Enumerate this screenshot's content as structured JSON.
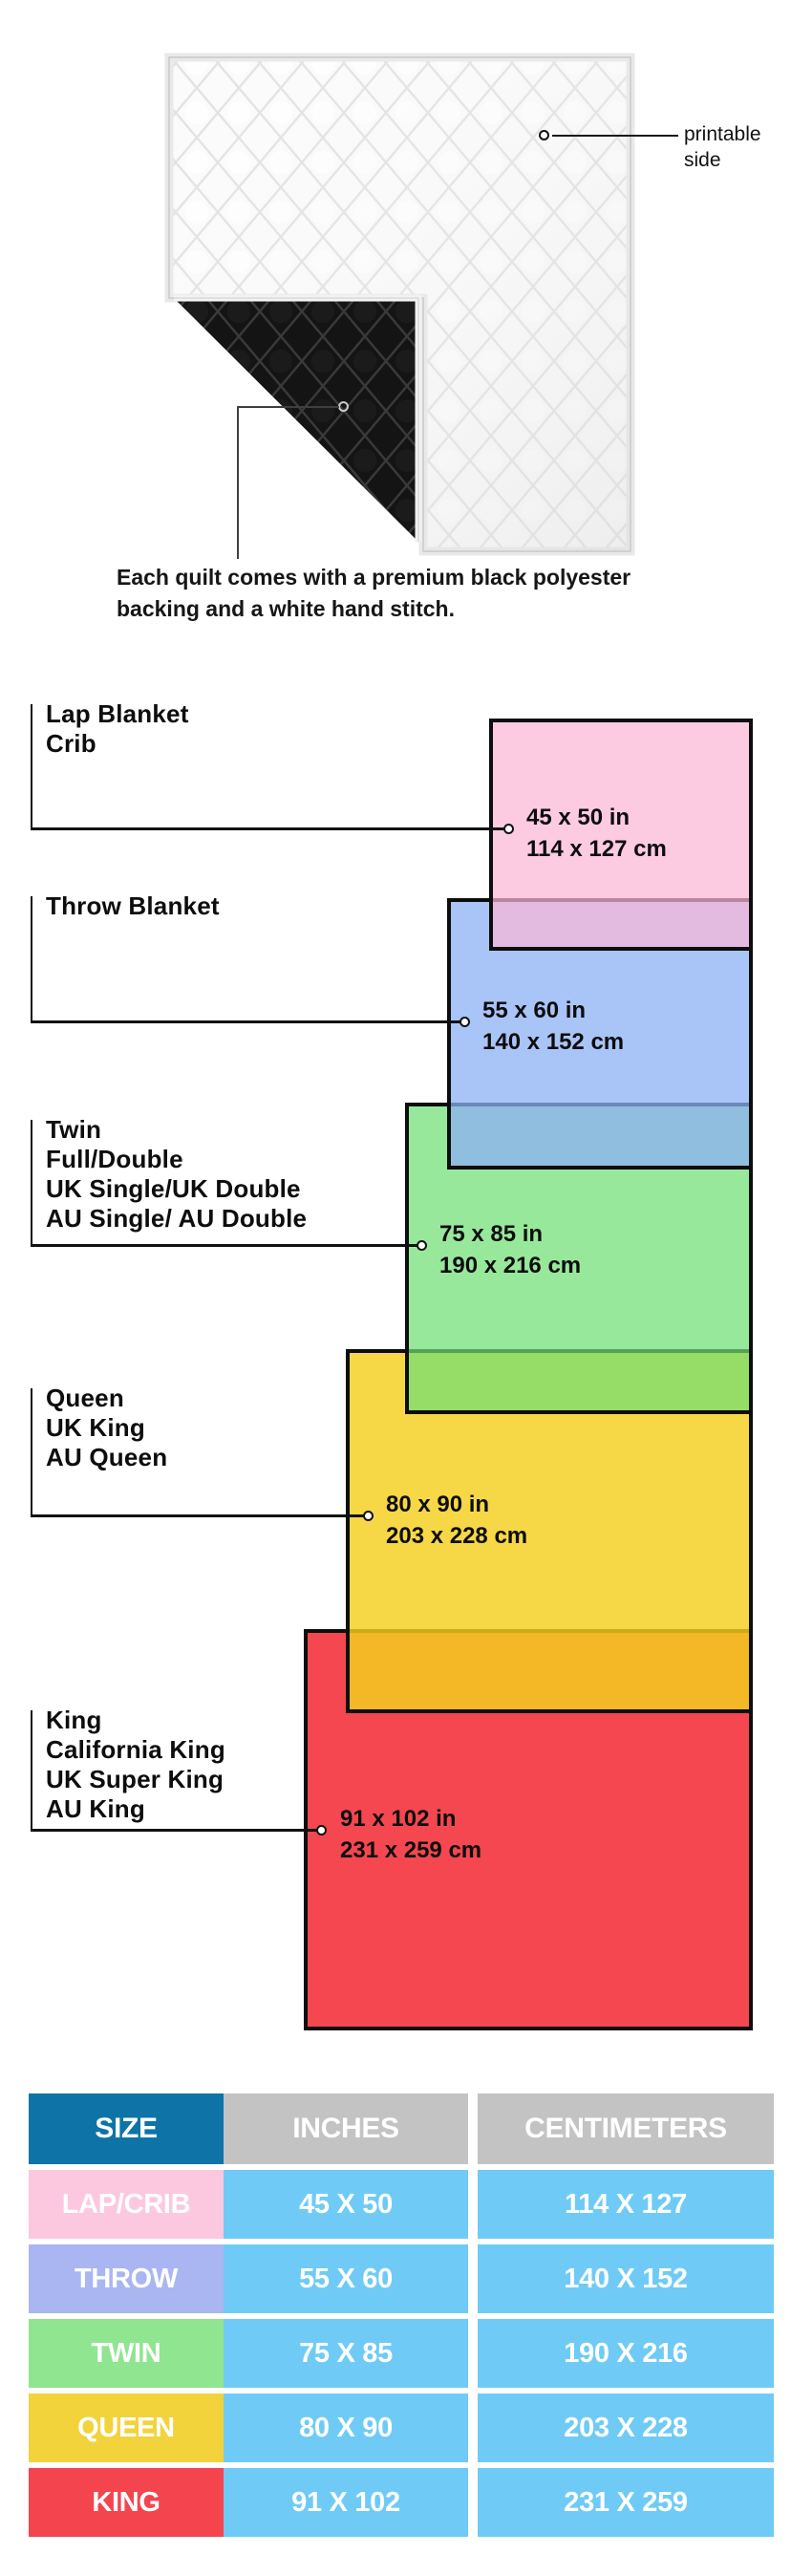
{
  "hero": {
    "printable_label_lines": [
      "printable",
      "side"
    ],
    "caption_lines": [
      "Each quilt comes with a premium black polyester",
      "backing and a white hand stitch."
    ]
  },
  "diagram": {
    "groups": [
      {
        "id": "lap-crib",
        "names": [
          "Lap Blanket",
          "Crib"
        ],
        "inches": "45 x 50 in",
        "cm": "114 x 127 cm",
        "color": "#FFC8DF"
      },
      {
        "id": "throw",
        "names": [
          "Throw Blanket"
        ],
        "inches": "55 x 60 in",
        "cm": "140 x 152 cm",
        "color": "#A9C4F7"
      },
      {
        "id": "twin",
        "names": [
          "Twin",
          "Full/Double",
          "UK Single/UK Double",
          "AU Single/ AU Double"
        ],
        "inches": "75 x 85 in",
        "cm": "190 x 216 cm",
        "color": "#98E89B"
      },
      {
        "id": "queen",
        "names": [
          "Queen",
          "UK King",
          "AU Queen"
        ],
        "inches": "80 x 90 in",
        "cm": "203 x 228 cm",
        "color": "#F6D73F"
      },
      {
        "id": "king",
        "names": [
          "King",
          "California King",
          "UK Super King",
          "AU King"
        ],
        "inches": "91 x 102 in",
        "cm": "231 x 259 cm",
        "color": "#F4474F"
      }
    ],
    "overlap_colors": {
      "lap_over_throw": "#E2B9E8",
      "throw_over_twin": "#8BBBDC",
      "twin_over_queen": "#96DD60",
      "queen_over_king": "#F5AE21"
    }
  },
  "table": {
    "headers": [
      "SIZE",
      "INCHES",
      "CENTIMETERS"
    ],
    "header_colors": {
      "size": "#0E74A8",
      "others": "#C3C3C3",
      "value_cells": "#6FCBF5"
    },
    "rows": [
      {
        "size": "LAP/CRIB",
        "inches": "45 X 50",
        "cm": "114 X 127",
        "color": "#FBC8E0"
      },
      {
        "size": "THROW",
        "inches": "55 X 60",
        "cm": "140 X 152",
        "color": "#A9B6F2"
      },
      {
        "size": "TWIN",
        "inches": "75 X 85",
        "cm": "190 X 216",
        "color": "#90E591"
      },
      {
        "size": "QUEEN",
        "inches": "80 X 90",
        "cm": "203 X 228",
        "color": "#F2D33C"
      },
      {
        "size": "KING",
        "inches": "91 X 102",
        "cm": "231 X 259",
        "color": "#F4454F"
      }
    ]
  }
}
